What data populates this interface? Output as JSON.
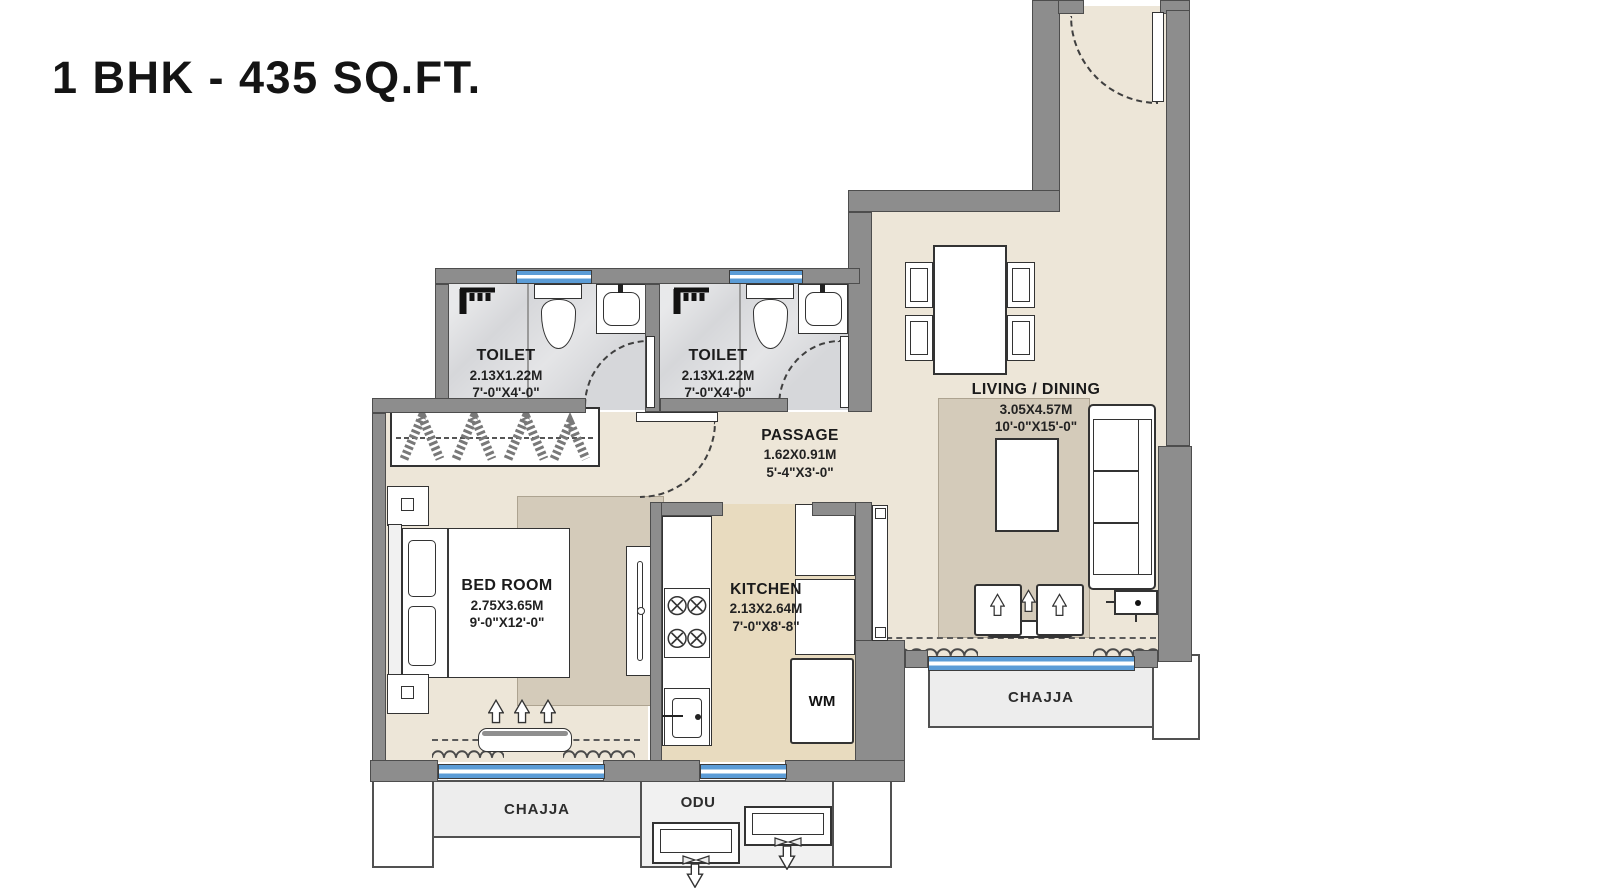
{
  "title": "1 BHK - 435 SQ.FT.",
  "rooms": {
    "toilet_1": {
      "label": "TOILET",
      "dim_m": "2.13X1.22M",
      "dim_ft": "7'-0\"X4'-0\""
    },
    "toilet_2": {
      "label": "TOILET",
      "dim_m": "2.13X1.22M",
      "dim_ft": "7'-0\"X4'-0\""
    },
    "passage": {
      "label": "PASSAGE",
      "dim_m": "1.62X0.91M",
      "dim_ft": "5'-4\"X3'-0\""
    },
    "living_dining": {
      "label": "LIVING / DINING",
      "dim_m": "3.05X4.57M",
      "dim_ft": "10'-0\"X15'-0\""
    },
    "bed_room": {
      "label": "BED ROOM",
      "dim_m": "2.75X3.65M",
      "dim_ft": "9'-0\"X12'-0\""
    },
    "kitchen": {
      "label": "KITCHEN",
      "dim_m": "2.13X2.64M",
      "dim_ft": "7'-0\"X8'-8\""
    }
  },
  "annotations": {
    "chajja_bottom": "CHAJJA",
    "chajja_right": "CHAJJA",
    "odu": "ODU",
    "washing_machine": "WM"
  },
  "icons": [
    "shower-icon",
    "wc-toilet-icon",
    "washbasin-icon",
    "hob-burners-icon",
    "sink-icon",
    "tv-panel-icon",
    "wardrobe-hangers-icon",
    "door-swing-arc",
    "curtain-icon",
    "arrow-up-icon",
    "arrow-down-icon",
    "odu-fan-icon"
  ],
  "colors": {
    "wall": "#8d8d8d",
    "wall_edge": "#4d4d4d",
    "floor_beige": "#ede6d8",
    "floor_kitchen": "#e8dbbf",
    "floor_toilet": "#d6d7da",
    "rug": "#d4cbba",
    "window_blue": "#5b9cd6",
    "chajja_fill": "#ededed",
    "line_dark": "#333333"
  }
}
